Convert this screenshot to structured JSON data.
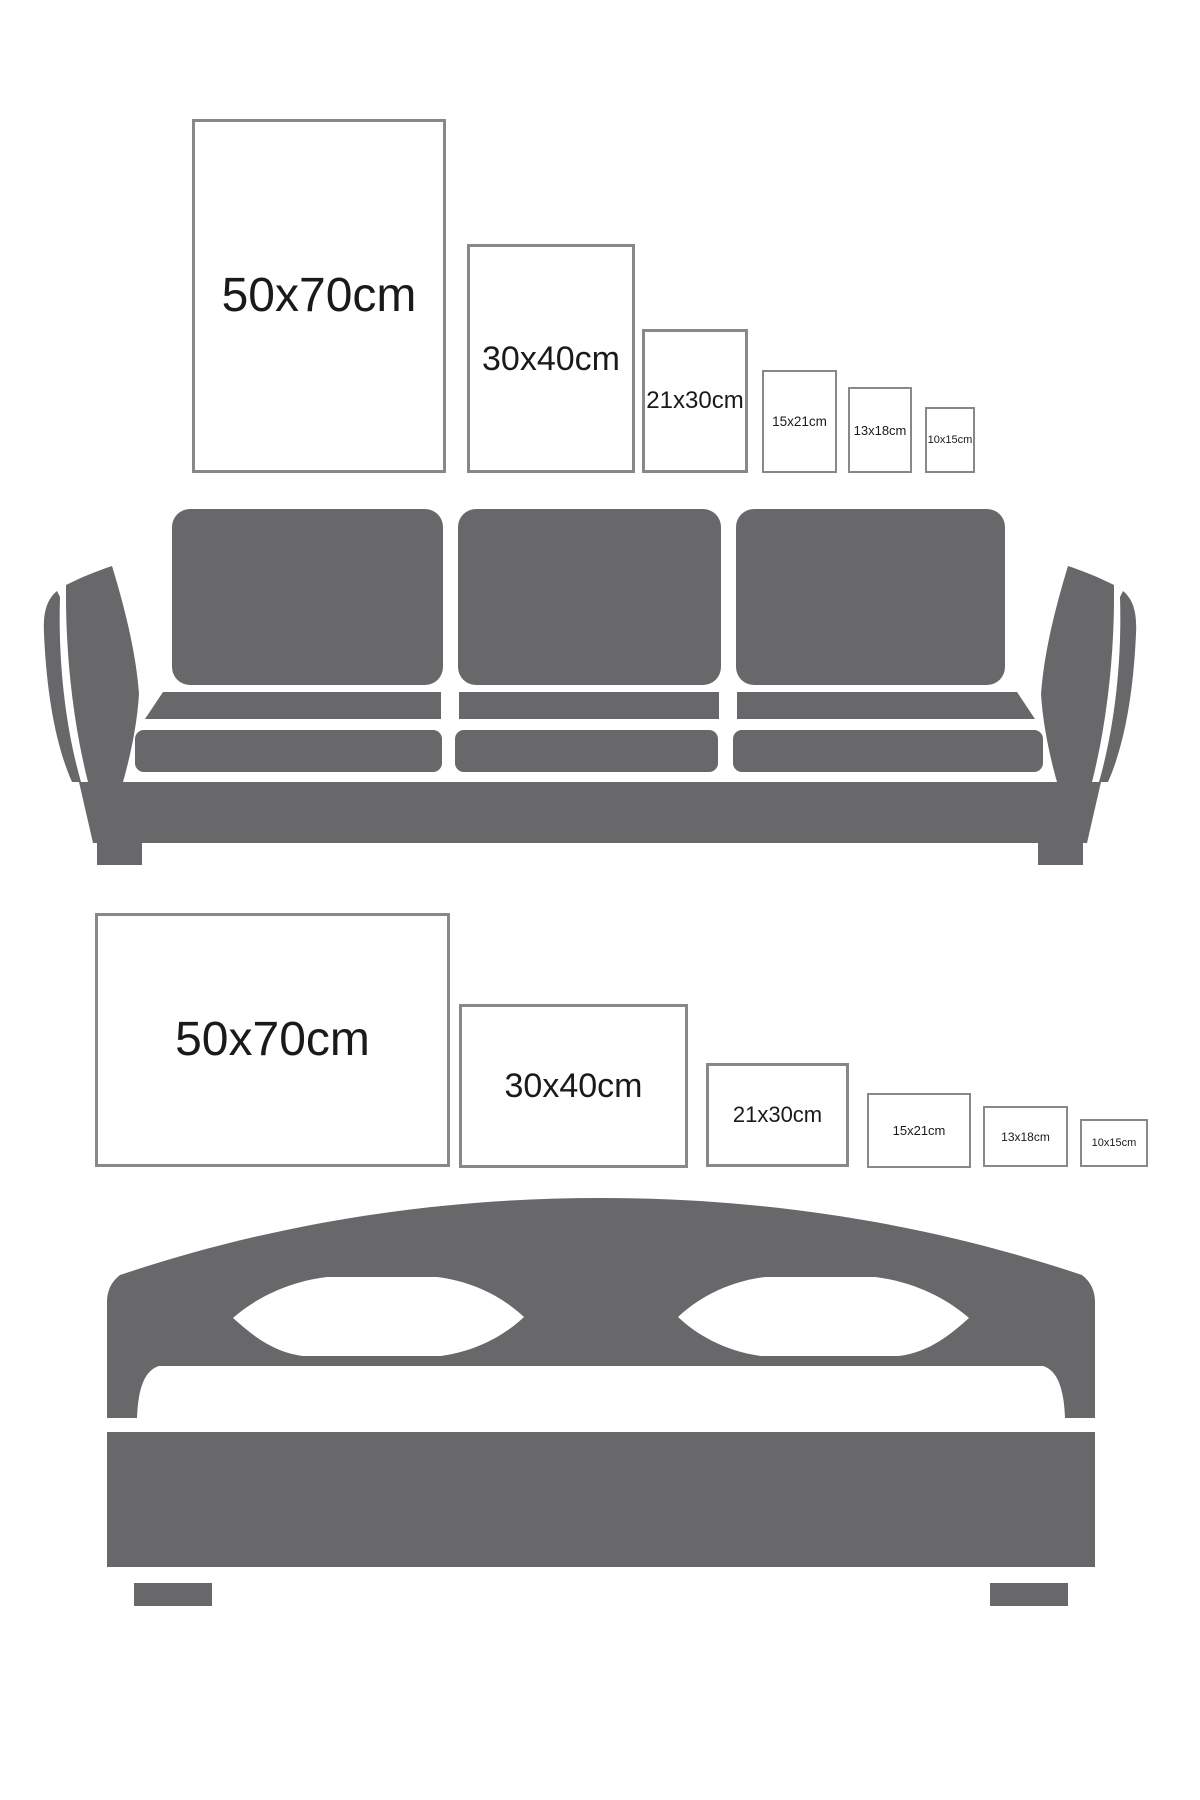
{
  "title": "Poster frame size guide above sofa and bed",
  "colors": {
    "furniture_gray": "#68686a",
    "frame_border_gray": "#88888b",
    "label_text": "#1a1a1a",
    "background": "#ffffff"
  },
  "sofa_section": {
    "furniture": "sofa",
    "orientation": "portrait",
    "frames": [
      {
        "label": "50x70cm"
      },
      {
        "label": "30x40cm"
      },
      {
        "label": "21x30cm"
      },
      {
        "label": "15x21cm"
      },
      {
        "label": "13x18cm"
      },
      {
        "label": "10x15cm"
      }
    ]
  },
  "bed_section": {
    "furniture": "bed",
    "orientation": "landscape",
    "frames": [
      {
        "label": "50x70cm"
      },
      {
        "label": "30x40cm"
      },
      {
        "label": "21x30cm"
      },
      {
        "label": "15x21cm"
      },
      {
        "label": "13x18cm"
      },
      {
        "label": "10x15cm"
      }
    ]
  }
}
